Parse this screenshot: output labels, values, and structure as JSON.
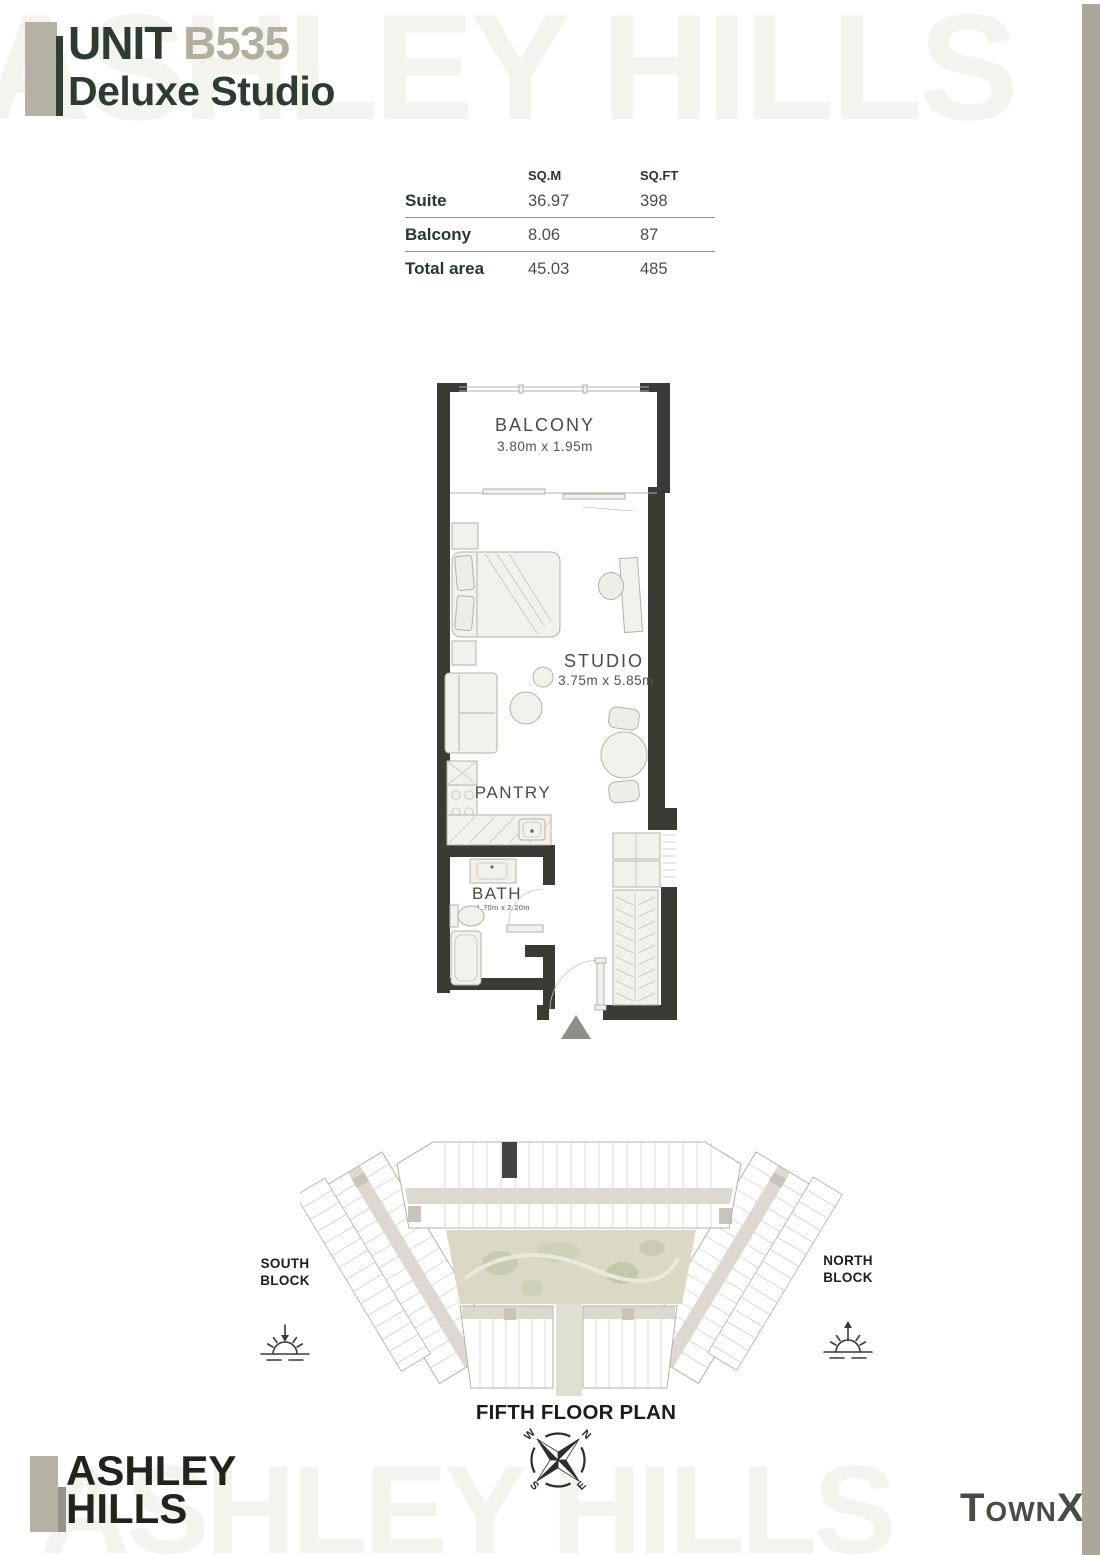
{
  "header": {
    "unit_word": "UNIT",
    "unit_number": "B535",
    "unit_type": "Deluxe Studio"
  },
  "area_table": {
    "col_headers": [
      "SQ.M",
      "SQ.FT"
    ],
    "rows": [
      {
        "label": "Suite",
        "sqm": "36.97",
        "sqft": "398"
      },
      {
        "label": "Balcony",
        "sqm": "8.06",
        "sqft": "87"
      },
      {
        "label": "Total area",
        "sqm": "45.03",
        "sqft": "485"
      }
    ]
  },
  "unit_plan": {
    "balcony_label": "BALCONY",
    "balcony_dims": "3.80m x 1.95m",
    "studio_label": "STUDIO",
    "studio_dims": "3.75m x 5.85m",
    "pantry_label": "PANTRY",
    "bath_label": "BATH",
    "bath_dims": "1.70m x 2.20m"
  },
  "site_plan": {
    "south_block_line1": "SOUTH",
    "south_block_line2": "BLOCK",
    "north_block_line1": "NORTH",
    "north_block_line2": "BLOCK",
    "caption": "FIFTH FLOOR PLAN",
    "compass": {
      "n": "N",
      "e": "E",
      "s": "S",
      "w": "W"
    }
  },
  "branding": {
    "watermark": "ASHLEY HILLS",
    "logo_line1": "ASHLEY",
    "logo_line2": "HILLS",
    "developer": "TownX"
  },
  "colors": {
    "accent_dark": "#2e3b33",
    "accent_beige": "#b5b2a3",
    "wall": "#3a3a37",
    "courtyard": "#d9d9c6"
  }
}
